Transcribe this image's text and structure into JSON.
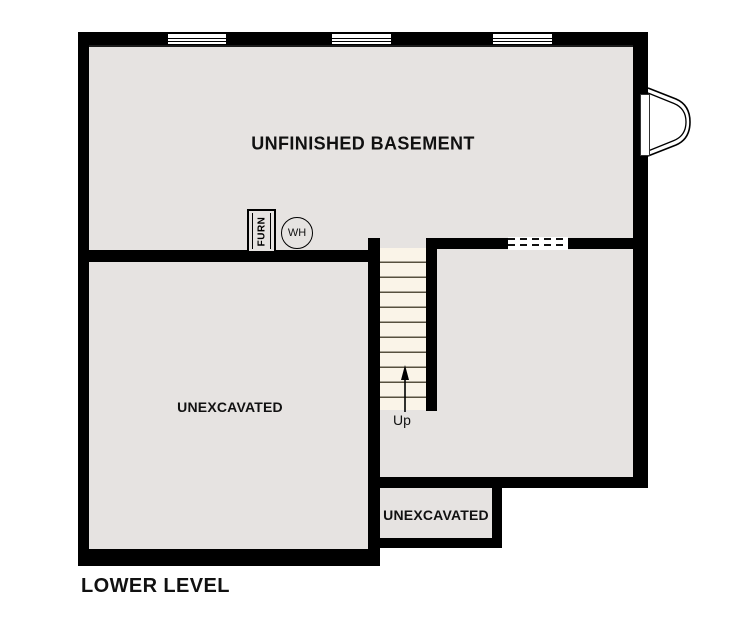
{
  "title": "LOWER LEVEL",
  "colors": {
    "wall": "#000000",
    "room_fill": "#e6e3e1",
    "stair_fill": "#faf4e8",
    "background": "#ffffff"
  },
  "rooms": {
    "basement": {
      "label": "UNFINISHED BASEMENT"
    },
    "left_unexcavated": {
      "label": "UNEXCAVATED"
    },
    "small_unexcavated": {
      "label": "UNEXCAVATED"
    }
  },
  "fixtures": {
    "furnace": {
      "label": "FURN"
    },
    "water_heater": {
      "label": "WH"
    }
  },
  "stairs": {
    "direction_label": "Up"
  }
}
